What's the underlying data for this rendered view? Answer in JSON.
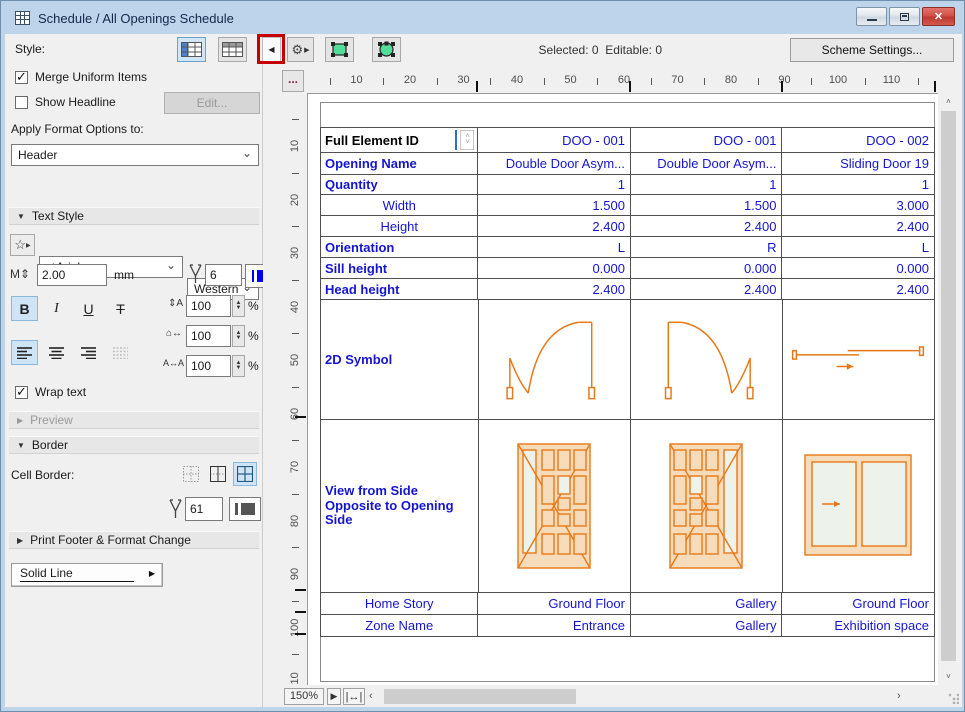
{
  "window": {
    "title": "Schedule /  All Openings Schedule",
    "controls": {
      "minimize": "minimize",
      "restore": "restore",
      "close": "✕"
    }
  },
  "toolbar": {
    "style_label": "Style:",
    "selected_label": "Selected:",
    "selected_value": "0",
    "editable_label": "Editable:",
    "editable_value": "0",
    "scheme_settings_label": "Scheme Settings..."
  },
  "annotation": {
    "type": "red-box-highlight",
    "target": "collapse-panel-button",
    "color": "#c40000"
  },
  "left_panel": {
    "merge_uniform_items": {
      "label": "Merge Uniform Items",
      "checked": true
    },
    "show_headline": {
      "label": "Show Headline",
      "checked": false
    },
    "edit_button_label": "Edit...",
    "apply_format_label": "Apply Format Options to:",
    "apply_format_value": "Header",
    "text_style": {
      "title": "Text Style",
      "font_check": "✓",
      "font_value": "Arial",
      "script_value": "Western",
      "size_value": "2.00",
      "size_unit": "mm",
      "pen_value": "6",
      "bold": "B",
      "italic": "I",
      "underline": "U",
      "strikethrough": "T",
      "line_spacing_value": "100",
      "width_factor_value": "100",
      "char_spacing_value": "100",
      "percent": "%"
    },
    "wrap_text": {
      "label": "Wrap text",
      "checked": true
    },
    "preview_title": "Preview",
    "border": {
      "title": "Border",
      "cell_border_label": "Cell Border:",
      "line_type_value": "Solid Line",
      "pen_value": "61"
    },
    "print_footer_title": "Print Footer & Format Change"
  },
  "ruler": {
    "h_numbers": [
      10,
      20,
      30,
      40,
      50,
      60,
      70,
      80,
      90,
      100,
      110
    ],
    "v_numbers": [
      10,
      20,
      30,
      40,
      50,
      60,
      70,
      80,
      90,
      100,
      110
    ]
  },
  "statusbar": {
    "zoom_value": "150%"
  },
  "icons": {
    "collapse_panel": "◀",
    "flyout_arrow": "▶",
    "gear": "⚙",
    "star": "☆",
    "chevron_down": "⌄",
    "spin_up": "▲",
    "spin_down": "▼",
    "scroll_up": "▲",
    "scroll_down": "▼",
    "scroll_left": "‹",
    "scroll_right": "›",
    "ellipsis": "...",
    "sort_up": "˄",
    "sort_down": "˅",
    "fit_width": "↔"
  },
  "colors": {
    "annotation_red": "#c40000",
    "table_text_blue": "#1515d0",
    "drawing_orange": "#e87818",
    "pen6_blue": "#0000ee",
    "pen61_gray": "#555555",
    "selected_highlight": "#cfe5f7"
  },
  "schedule": {
    "rows": [
      {
        "key": "full-element-id",
        "label": "Full Element ID",
        "label_style": "edit",
        "kind": "text",
        "values": [
          "DOO - 001",
          "DOO - 001",
          "DOO - 002"
        ]
      },
      {
        "key": "opening-name",
        "label": "Opening Name",
        "label_style": "bold",
        "kind": "text",
        "values": [
          "Double Door Asym...",
          "Double Door Asym...",
          "Sliding Door 19"
        ]
      },
      {
        "key": "quantity",
        "label": "Quantity",
        "label_style": "bold",
        "kind": "text",
        "values": [
          "1",
          "1",
          "1"
        ]
      },
      {
        "key": "width",
        "label": "Width",
        "label_style": "center",
        "kind": "text",
        "values": [
          "1.500",
          "1.500",
          "3.000"
        ]
      },
      {
        "key": "height",
        "label": "Height",
        "label_style": "center",
        "kind": "text",
        "values": [
          "2.400",
          "2.400",
          "2.400"
        ]
      },
      {
        "key": "orientation",
        "label": "Orientation",
        "label_style": "bold",
        "kind": "text",
        "values": [
          "L",
          "R",
          "L"
        ]
      },
      {
        "key": "sill-height",
        "label": "Sill height",
        "label_style": "bold",
        "kind": "text",
        "values": [
          "0.000",
          "0.000",
          "0.000"
        ]
      },
      {
        "key": "head-height",
        "label": "Head height",
        "label_style": "bold",
        "kind": "text",
        "values": [
          "2.400",
          "2.400",
          "2.400"
        ]
      },
      {
        "key": "symbol-2d",
        "label": "2D Symbol",
        "label_style": "bold",
        "kind": "drawing",
        "values": [
          "plan-door-left",
          "plan-door-right",
          "plan-sliding-door"
        ]
      },
      {
        "key": "view-from-side",
        "label": "View from Side Opposite to Opening Side",
        "label_style": "bold",
        "kind": "drawing",
        "values": [
          "elev-door-left",
          "elev-door-right",
          "elev-sliding-door"
        ]
      },
      {
        "key": "home-story",
        "label": "Home Story",
        "label_style": "center",
        "kind": "text",
        "values": [
          "Ground Floor",
          "Gallery",
          "Ground Floor"
        ]
      },
      {
        "key": "zone-name",
        "label": "Zone Name",
        "label_style": "center",
        "kind": "text",
        "values": [
          "Entrance",
          "Gallery",
          "Exhibition space"
        ]
      }
    ]
  }
}
